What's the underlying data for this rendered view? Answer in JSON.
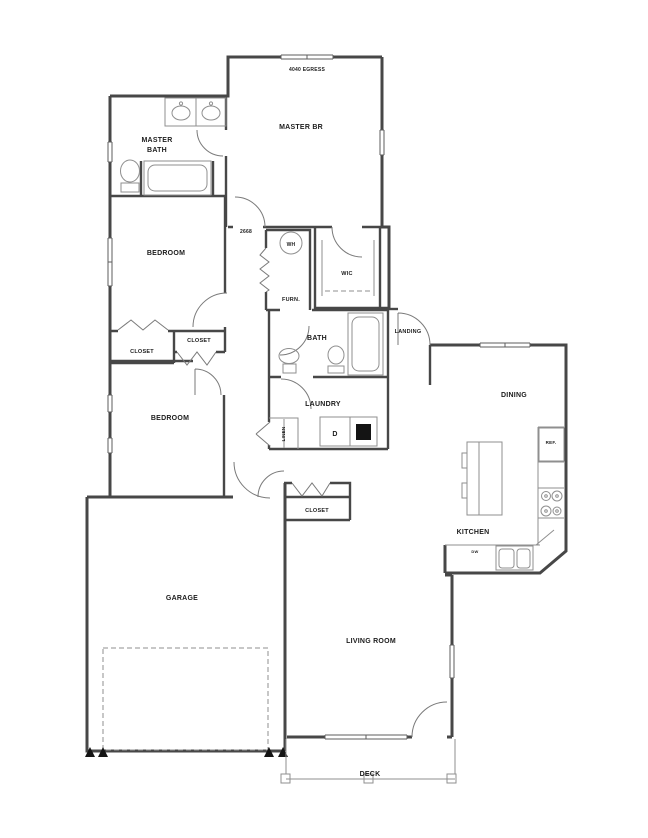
{
  "colors": {
    "wall": "#474747",
    "fixture": "#8f8f8f",
    "door": "#7a7a7a",
    "window": "#5e5e5e",
    "text": "#1c1c1c",
    "appliance_fill": "#141414",
    "background": "#ffffff"
  },
  "labels": {
    "egress_window": "4040 EGRESS",
    "master_br": "MASTER BR",
    "master_bath_line1": "MASTER",
    "master_bath_line2": "BATH",
    "bedroom": "BEDROOM",
    "closet": "CLOSET",
    "door_size": "2668",
    "water_heater": "WH",
    "furnace": "FURN.",
    "walk_in_closet": "WIC",
    "bath": "BATH",
    "landing": "LANDING",
    "laundry": "LAUNDRY",
    "dryer": "D",
    "linen": "LINEN",
    "dining": "DINING",
    "refrigerator": "REF.",
    "kitchen": "KITCHEN",
    "dishwasher": "DW",
    "garage": "GARAGE",
    "living_room": "LIVING ROOM",
    "deck": "DECK"
  }
}
